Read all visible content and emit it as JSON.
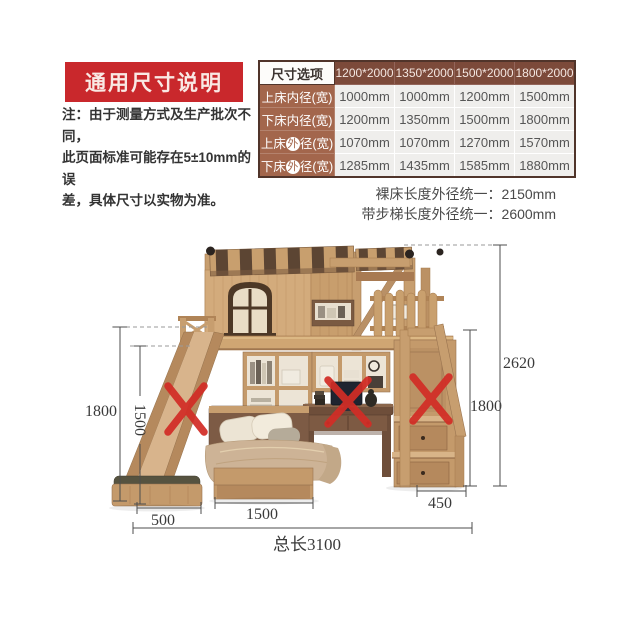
{
  "header": {
    "title": "通用尺寸说明",
    "note_lines": [
      "注：由于测量方式及生产批次不同，",
      "此页面标准可能存在5±10mm的误",
      "差，具体尺寸以实物为准。"
    ]
  },
  "size_table": {
    "corner_header": "尺寸选项",
    "columns": [
      "1200*2000",
      "1350*2000",
      "1500*2000",
      "1800*2000"
    ],
    "rows": [
      {
        "label_pre": "上床内径(宽)",
        "label_circle": "",
        "label_post": "",
        "values": [
          "1000mm",
          "1000mm",
          "1200mm",
          "1500mm"
        ]
      },
      {
        "label_pre": "下床内径(宽)",
        "label_circle": "",
        "label_post": "",
        "values": [
          "1200mm",
          "1350mm",
          "1500mm",
          "1800mm"
        ]
      },
      {
        "label_pre": "上床",
        "label_circle": "外",
        "label_post": "径(宽)",
        "values": [
          "1070mm",
          "1070mm",
          "1270mm",
          "1570mm"
        ]
      },
      {
        "label_pre": "下床",
        "label_circle": "外",
        "label_post": "径(宽)",
        "values": [
          "1285mm",
          "1435mm",
          "1585mm",
          "1880mm"
        ]
      }
    ]
  },
  "notes_below_table": {
    "bare_bed": "裸床长度外径统一：2150mm",
    "with_ladder": "带步梯长度外径统一：2600mm"
  },
  "diagram": {
    "dims": {
      "left_height": "1800",
      "left_bed_height": "1500",
      "slide_width": "500",
      "bed_length": "1500",
      "stairs_depth": "450",
      "right_bed_height": "1800",
      "total_height": "2620",
      "total_length": "总长3100"
    }
  },
  "colors": {
    "banner_red": "#c9282c",
    "table_header_brown": "#7c4a3a",
    "table_label_brown": "#a3664c",
    "x_mark_red": "#d22d26",
    "wood_light": "#d3ab7c",
    "wood_mid": "#c49a6b",
    "roof_dark": "#5c4533"
  }
}
